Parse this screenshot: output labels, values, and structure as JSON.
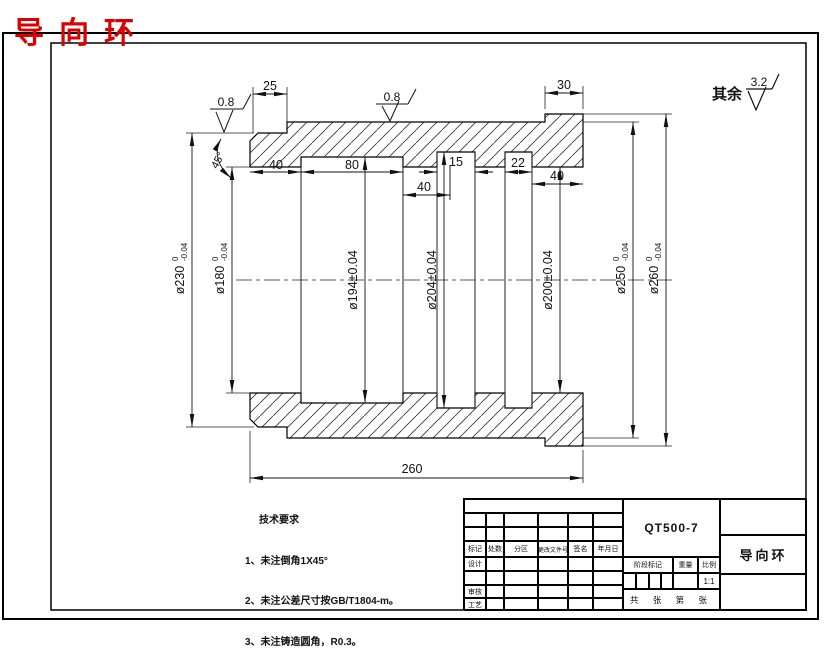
{
  "page_title": "导向环",
  "surface_note": {
    "prefix": "其余",
    "value": "3.2"
  },
  "roughness": {
    "r1": "0.8",
    "r2": "0.8"
  },
  "chamfer_angle": "45°",
  "dims": {
    "notch_width": "25",
    "flange_width": "30",
    "seg_a": "40",
    "seg_b": "80",
    "seg_c": "15",
    "seg_d": "22",
    "seg_e": "40",
    "seg_f": "40",
    "total_length": "260"
  },
  "diameters": [
    {
      "name": "ø230",
      "sup": "0",
      "sub": "-0.04"
    },
    {
      "name": "ø180",
      "sup": "0",
      "sub": "-0.04"
    },
    {
      "name": "ø194±0.04"
    },
    {
      "name": "ø204±0.04"
    },
    {
      "name": "ø200±0.04"
    },
    {
      "name": "ø250",
      "sup": "0",
      "sub": "-0.04"
    },
    {
      "name": "ø260",
      "sup": "0",
      "sub": "-0.04"
    }
  ],
  "tech_requirements": {
    "title": "技术要求",
    "items": [
      "1、未注倒角1X45°",
      "2、未注公差尺寸按GB/T1804-m。",
      "3、未注铸造圆角，R0.3。"
    ]
  },
  "title_block": {
    "material": "QT500-7",
    "part_name": "导向环",
    "headers": [
      "标记",
      "处数",
      "分区",
      "更改文件号",
      "签名",
      "年月日"
    ],
    "row_labels": [
      "设计",
      "审核",
      "工艺"
    ],
    "stage_label": "阶段标记",
    "weight_label": "重量",
    "scale_label": "比例",
    "scale_value": "1:1",
    "sheet_note": "共 张 第 张"
  }
}
